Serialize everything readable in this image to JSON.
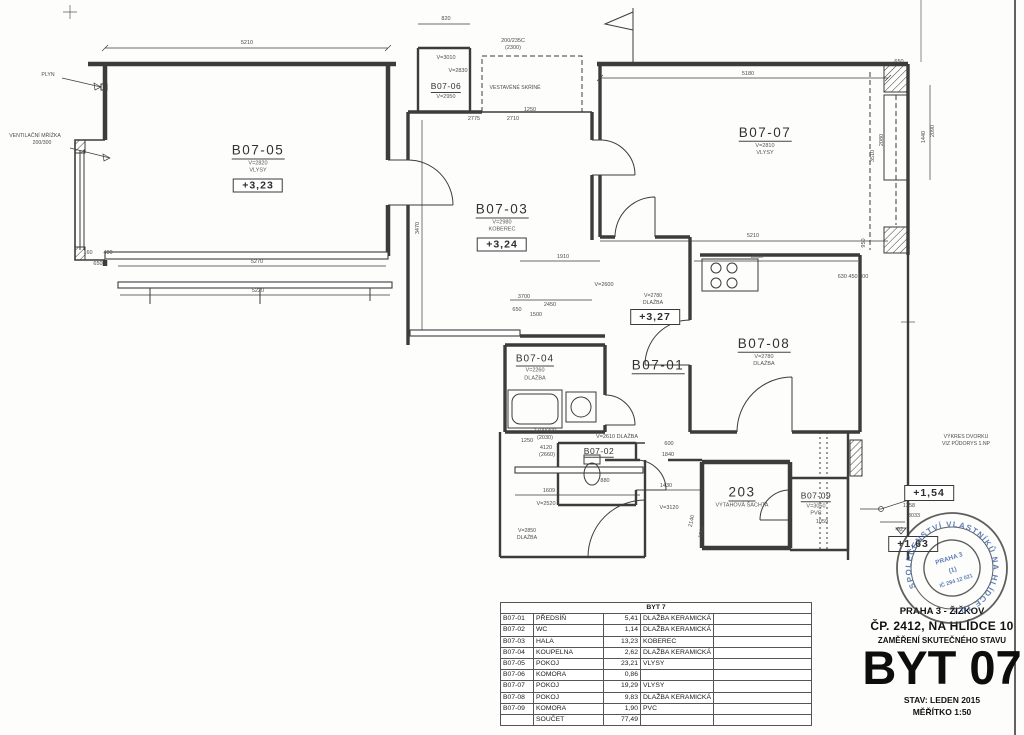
{
  "rooms": {
    "r05": {
      "label": "B07-05",
      "v": "V=2820",
      "floor": "VLYSY",
      "elev": "+3,23"
    },
    "r03": {
      "label": "B07-03",
      "v": "V=2980",
      "floor": "KOBEREC",
      "elev": "+3,24"
    },
    "r07": {
      "label": "B07-07",
      "v": "V=2810",
      "floor": "VLYSY"
    },
    "r08": {
      "label": "B07-08",
      "v": "V=2780",
      "floor": "DLAŽBA"
    },
    "r04": {
      "label": "B07-04",
      "v": "V=2260",
      "floor": "DLAŽBA"
    },
    "r01": {
      "label": "B07-01"
    },
    "r02": {
      "label": "B07-02"
    },
    "r06": {
      "label": "B07-06",
      "v": "V=2950"
    },
    "r09": {
      "label": "B07-09",
      "v": "V=3050",
      "floor": "PVC"
    },
    "shaft": {
      "label": "203",
      "name": "VÝTAHOVÁ ŠACHTA"
    }
  },
  "annotations": {
    "gas": "PLYN",
    "vent1": "VENTILAČNÍ MŘÍŽKA",
    "vent2": "200/300",
    "wardrobe": "VESTAVĚNÉ SKŘÍNĚ",
    "note1": "VÝKRES DVORKU",
    "note2": "VIZ PŮDORYS 1.NP",
    "elev_327": "+3,27",
    "elev_154": "+1,54",
    "elev_163": "+1,63",
    "v2780": "V=2780",
    "v2780_floor": "DLAŽBA",
    "v2850": "V=2850",
    "v2850_floor": "DLAŽBA"
  },
  "dims": [
    {
      "t": "5210",
      "x": 247,
      "y": 43
    },
    {
      "t": "820",
      "x": 446,
      "y": 19
    },
    {
      "t": "200/235C",
      "x": 513,
      "y": 41
    },
    {
      "t": "(2300)",
      "x": 513,
      "y": 48
    },
    {
      "t": "V=3010",
      "x": 446,
      "y": 58
    },
    {
      "t": "V=2830",
      "x": 458,
      "y": 71
    },
    {
      "t": "1250",
      "x": 530,
      "y": 110
    },
    {
      "t": "2775",
      "x": 474,
      "y": 119
    },
    {
      "t": "2710",
      "x": 513,
      "y": 119
    },
    {
      "t": "5180",
      "x": 748,
      "y": 74
    },
    {
      "t": "650",
      "x": 899,
      "y": 62
    },
    {
      "t": "5210",
      "x": 753,
      "y": 236
    },
    {
      "t": "1910",
      "x": 563,
      "y": 257
    },
    {
      "t": "3630",
      "x": 757,
      "y": 257
    },
    {
      "t": "5270",
      "x": 257,
      "y": 262
    },
    {
      "t": "5220",
      "x": 258,
      "y": 291
    },
    {
      "t": "480",
      "x": 108,
      "y": 253
    },
    {
      "t": "160",
      "x": 88,
      "y": 253
    },
    {
      "t": "650",
      "x": 98,
      "y": 264
    },
    {
      "t": "3470",
      "x": 418,
      "y": 228,
      "r": -90
    },
    {
      "t": "2090",
      "x": 933,
      "y": 131,
      "r": -90
    },
    {
      "t": "1440",
      "x": 924,
      "y": 137,
      "r": -90
    },
    {
      "t": "3510",
      "x": 873,
      "y": 156,
      "r": -90
    },
    {
      "t": "2080",
      "x": 882,
      "y": 140,
      "r": -90
    },
    {
      "t": "950",
      "x": 864,
      "y": 243,
      "r": -90
    },
    {
      "t": "3700",
      "x": 524,
      "y": 297
    },
    {
      "t": "650",
      "x": 517,
      "y": 310
    },
    {
      "t": "1500",
      "x": 536,
      "y": 315
    },
    {
      "t": "2450",
      "x": 550,
      "y": 305
    },
    {
      "t": "V=2600",
      "x": 604,
      "y": 285
    },
    {
      "t": "630 450 800",
      "x": 853,
      "y": 277
    },
    {
      "t": "1609",
      "x": 549,
      "y": 491
    },
    {
      "t": "V=2520",
      "x": 546,
      "y": 504
    },
    {
      "t": "1430",
      "x": 666,
      "y": 486
    },
    {
      "t": "V=3120",
      "x": 669,
      "y": 508
    },
    {
      "t": "880",
      "x": 605,
      "y": 481
    },
    {
      "t": "1840",
      "x": 668,
      "y": 455
    },
    {
      "t": "600",
      "x": 669,
      "y": 444
    },
    {
      "t": "1250",
      "x": 527,
      "y": 441
    },
    {
      "t": "2140",
      "x": 692,
      "y": 521,
      "r": -78
    },
    {
      "t": "1960",
      "x": 702,
      "y": 532,
      "r": -78
    },
    {
      "t": "1258",
      "x": 909,
      "y": 506
    },
    {
      "t": "3033",
      "x": 914,
      "y": 516
    },
    {
      "t": "-92",
      "x": 899,
      "y": 530
    },
    {
      "t": "V=2610 DLAŽBA",
      "x": 617,
      "y": 437
    },
    {
      "t": "2700/300",
      "x": 545,
      "y": 431
    },
    {
      "t": "(2030)",
      "x": 545,
      "y": 438
    },
    {
      "t": "4120",
      "x": 546,
      "y": 448
    },
    {
      "t": "(2660)",
      "x": 547,
      "y": 455
    },
    {
      "t": "1059",
      "x": 822,
      "y": 522
    }
  ],
  "table": {
    "title": "BYT 7",
    "rows": [
      [
        "B07-01",
        "PŘEDSÍŇ",
        "5,41",
        "DLAŽBA KERAMICKÁ"
      ],
      [
        "B07-02",
        "WC",
        "1,14",
        "DLAŽBA KERAMICKÁ"
      ],
      [
        "B07-03",
        "HALA",
        "13,23",
        "KOBEREC"
      ],
      [
        "B07-04",
        "KOUPELNA",
        "2,62",
        "DLAŽBA KERAMICKÁ"
      ],
      [
        "B07-05",
        "POKOJ",
        "23,21",
        "VLYSY"
      ],
      [
        "B07-06",
        "KOMORA",
        "0,86",
        ""
      ],
      [
        "B07-07",
        "POKOJ",
        "19,29",
        "VLYSY"
      ],
      [
        "B07-08",
        "POKOJ",
        "9,83",
        "DLAŽBA KERAMICKÁ"
      ],
      [
        "B07-09",
        "KOMORA",
        "1,90",
        "PVC"
      ],
      [
        "",
        "SOUČET",
        "77,49",
        ""
      ]
    ]
  },
  "titleblock": {
    "locality": "PRAHA 3 - ŽIŽKOV",
    "address": "ČP. 2412, NA HLÍDCE 10",
    "subtitle": "ZAMĚŘENÍ SKUTEČNÉHO STAVU",
    "unit": "BYT 07",
    "status": "STAV: LEDEN 2015",
    "scale": "MĚŘÍTKO 1:50"
  },
  "stamp": {
    "ring": "SPOLEČENSTVÍ VLASTNÍKŮ NA HLÍDCE 10 •",
    "line1": "PRAHA 3",
    "line2": "(1)",
    "line3": "IČ 294 12 021",
    "color": "#3f62a8"
  }
}
